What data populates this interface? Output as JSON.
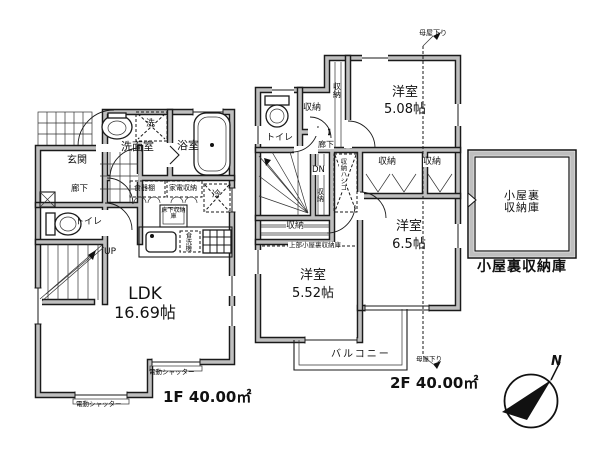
{
  "plan": {
    "floor1": {
      "genkan": "玄関",
      "hallway": "廊下",
      "toilet": "トイレ",
      "washroom": "洗面室",
      "bathroom": "浴室",
      "washer": "洗",
      "cupboard": "食器棚",
      "appliance_storage": "家電収納",
      "fridge": "冷",
      "underfloor_storage": "床下収納庫",
      "dishwasher": "食洗機",
      "stairs_up": "UP",
      "ldk_name": "LDK",
      "ldk_size": "16.69帖",
      "shutter_right": "電動シャッター",
      "shutter_bottom": "電動シャッター",
      "area": "1F 40.00㎡"
    },
    "floor2": {
      "roof_note_top": "母屋下り",
      "roof_note_bottom": "母屋下り",
      "toilet": "トイレ",
      "hallway": "廊下",
      "stairs_down": "DN",
      "closet_strip": "収納",
      "closet_hall": "収納",
      "closet_mid": "収納",
      "closet_under_stairs": "収納",
      "closet_right_a": "収納",
      "closet_right_b": "収納",
      "ladder": "収納ハシゴ",
      "attic_above": "上部小屋裏収納庫",
      "room_ne": {
        "name": "洋室",
        "size": "5.08帖"
      },
      "room_se": {
        "name": "洋室",
        "size": "6.5帖"
      },
      "room_sw": {
        "name": "洋室",
        "size": "5.52帖"
      },
      "balcony": "バルコニー",
      "area": "2F 40.00㎡"
    },
    "attic": {
      "inside_line1": "小屋裏",
      "inside_line2": "収納庫",
      "caption": "小屋裏収納庫"
    },
    "compass": {
      "north": "N"
    }
  }
}
